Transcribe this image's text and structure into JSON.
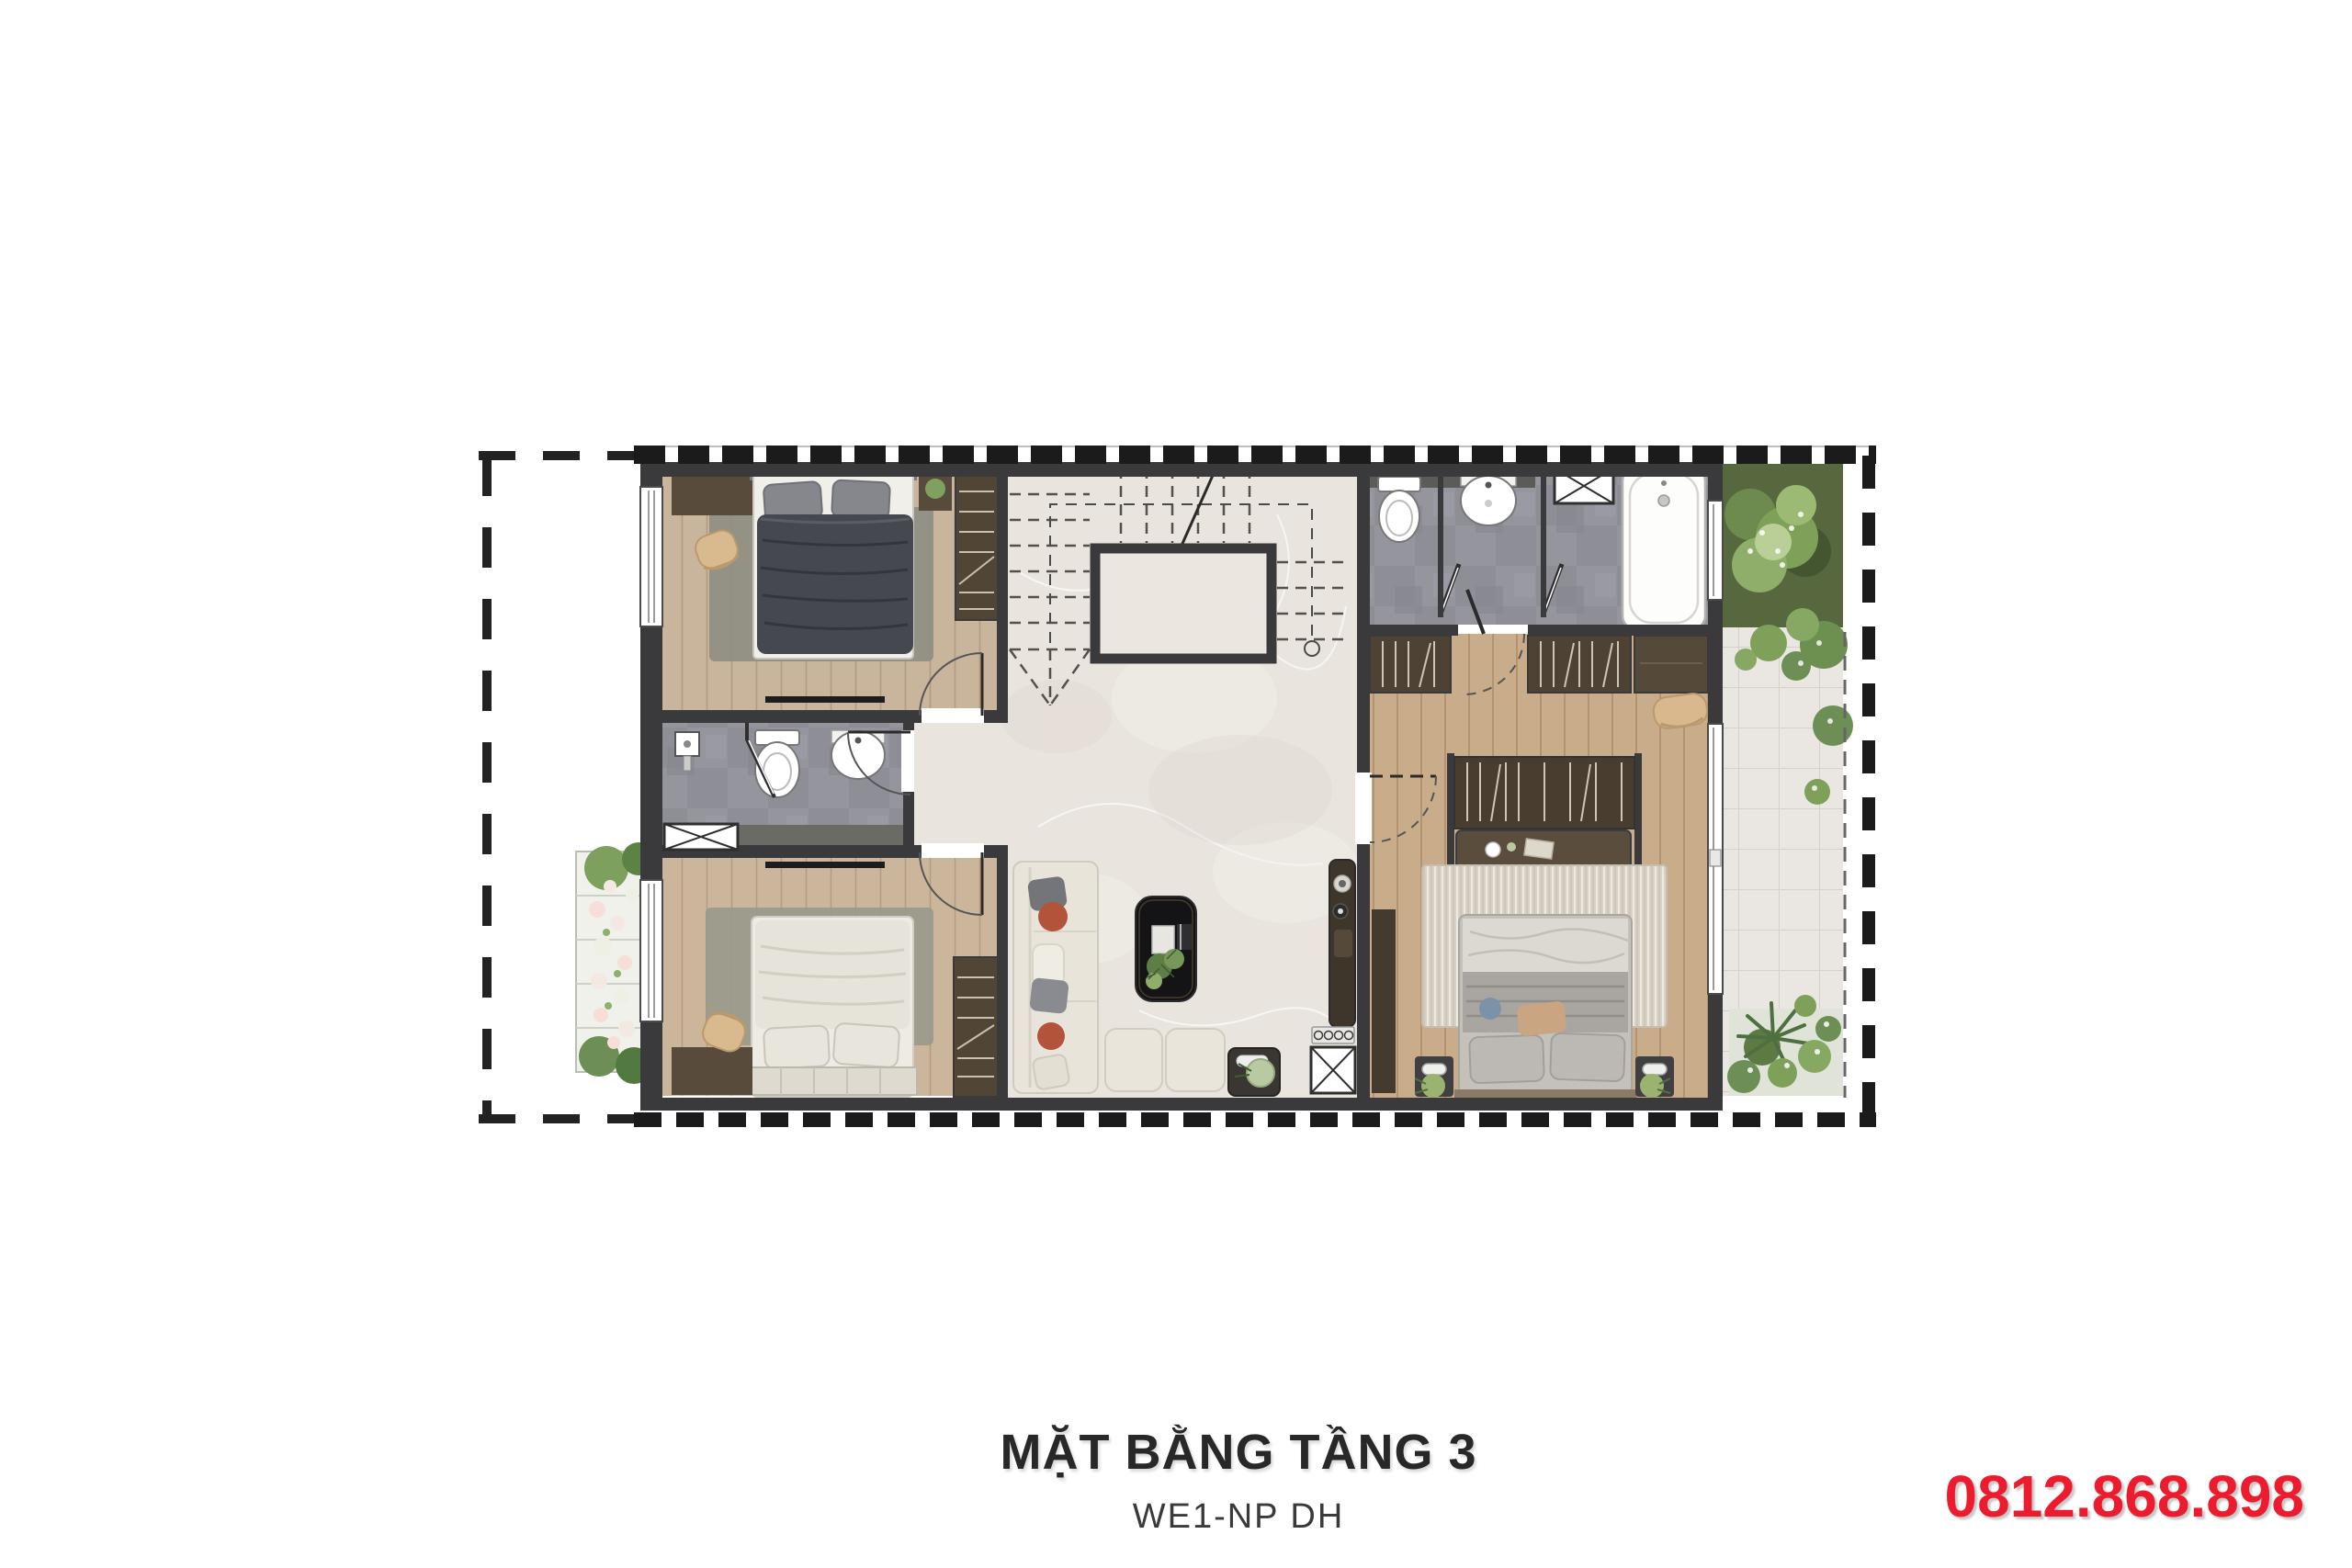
{
  "page": {
    "background": "#ffffff"
  },
  "caption": {
    "title": "MẶT BẰNG TẦNG 3",
    "subtitle": "WE1-NP DH"
  },
  "contact": {
    "phone": "0812.868.898"
  },
  "palette": {
    "accent_red": "#ec1c2e",
    "title_color": "#282828",
    "subtitle_color": "#3a3a3a",
    "wall": "#3a3a3c",
    "wood_light": "#c9b59b",
    "wood_master": "#c9ac89",
    "marble": "#e9e4dd",
    "tile_gray": "#95959e",
    "dark_wood": "#584b3c",
    "terrace_tile": "#eae6e1",
    "grass": "#57683f",
    "foliage": "#7fa058",
    "bed_dark": "#45484e",
    "bed_cream": "#edebe4",
    "bed_gray": "#b5b2ad",
    "sofa_cream": "#e9e4da",
    "terracotta": "#b2543a",
    "bathtub_white": "#fdfdfc"
  }
}
